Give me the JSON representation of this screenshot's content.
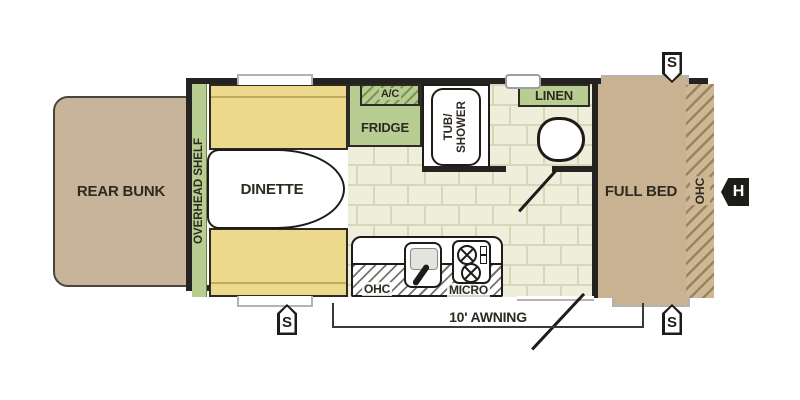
{
  "meta": {
    "title": "Travel trailer floor plan"
  },
  "colors": {
    "wall": "#24231f",
    "wood_tan": "#c9b292",
    "bunk_tan": "#c7b49a",
    "upholstery_yellow": "#ecd98c",
    "cabinet_green": "#b7cd92",
    "tile_floor": "#efeedb"
  },
  "areas": {
    "rear_bunk": "REAR BUNK",
    "overhead_shelf": "OVERHEAD SHELF",
    "dinette": "DINETTE",
    "fridge": "FRIDGE",
    "ac": "A/C",
    "tub_shower_line1": "TUB/",
    "tub_shower_line2": "SHOWER",
    "linen": "LINEN",
    "full_bed": "FULL BED",
    "ohc_bed": "OHC",
    "ohc_kitchen": "OHC",
    "micro": "MICRO"
  },
  "annotations": {
    "awning": "10' AWNING",
    "speaker": "S",
    "hookup": "H"
  }
}
